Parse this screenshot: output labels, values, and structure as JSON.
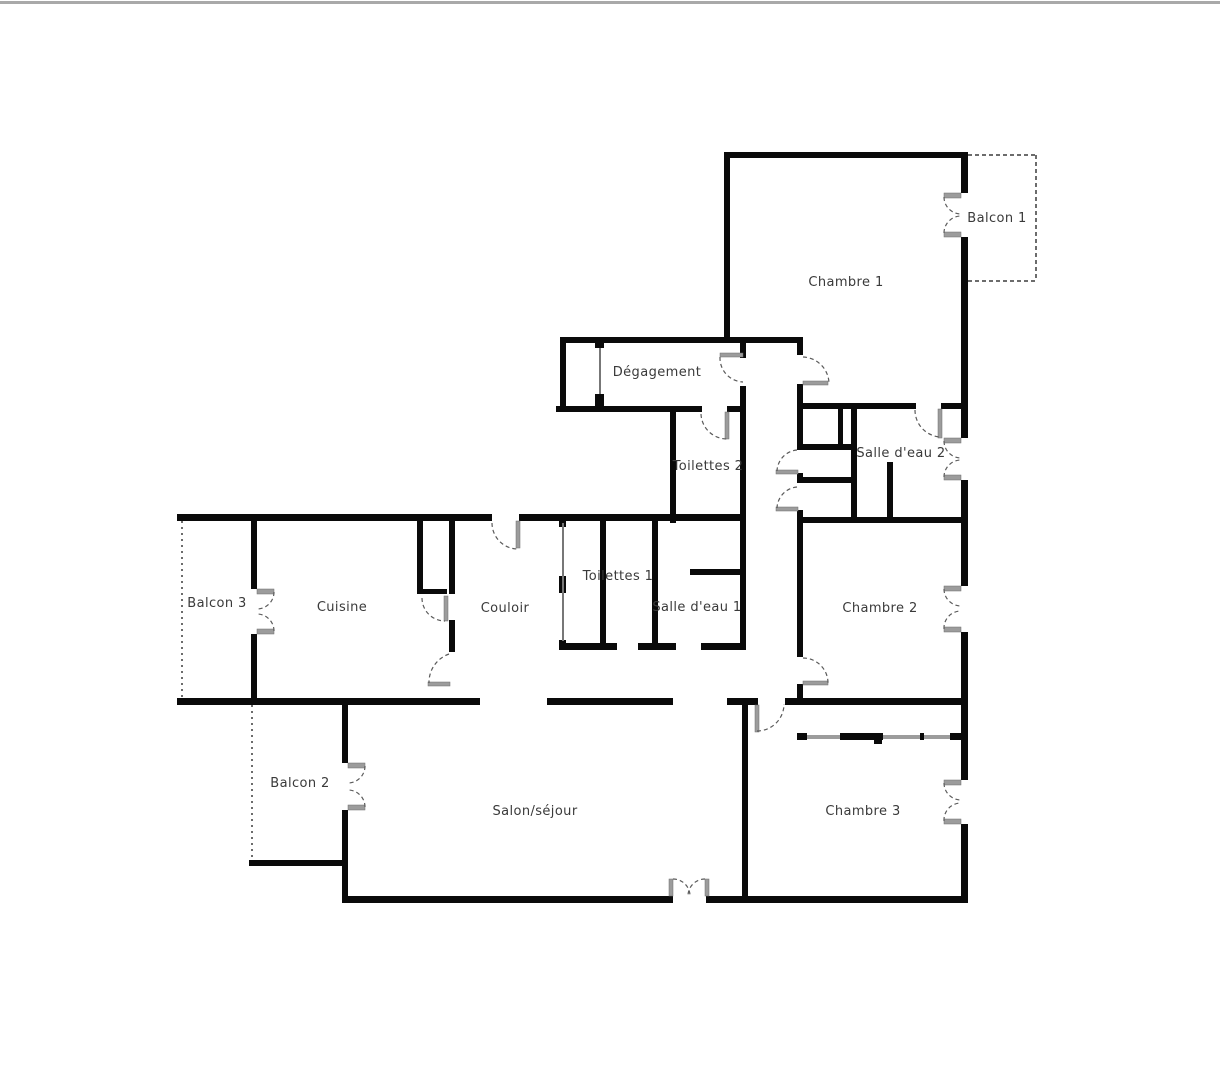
{
  "plan": {
    "type": "floor-plan",
    "wall_color": "#0a0a0a",
    "door_arc_color": "#5a5a5a",
    "door_leaf_color": "#9c9c9c",
    "balcony_dash_color": "#3c3c3c",
    "label_color": "#3a3a3a",
    "background_color": "#ffffff",
    "topbar_color": "#a9a9a9"
  },
  "rooms": {
    "chambre1": {
      "label": "Chambre 1"
    },
    "balcon1": {
      "label": "Balcon 1"
    },
    "degagement": {
      "label": "Dégagement"
    },
    "toilettes2": {
      "label": "Toilettes 2"
    },
    "salle_eau2": {
      "label": "Salle d'eau 2"
    },
    "balcon3": {
      "label": "Balcon 3"
    },
    "cuisine": {
      "label": "Cuisine"
    },
    "couloir": {
      "label": "Couloir"
    },
    "toilettes1": {
      "label": "Toilettes 1"
    },
    "salle_eau1": {
      "label": "Salle d'eau 1"
    },
    "chambre2": {
      "label": "Chambre 2"
    },
    "balcon2": {
      "label": "Balcon 2"
    },
    "salon": {
      "label": "Salon/séjour"
    },
    "chambre3": {
      "label": "Chambre 3"
    }
  }
}
